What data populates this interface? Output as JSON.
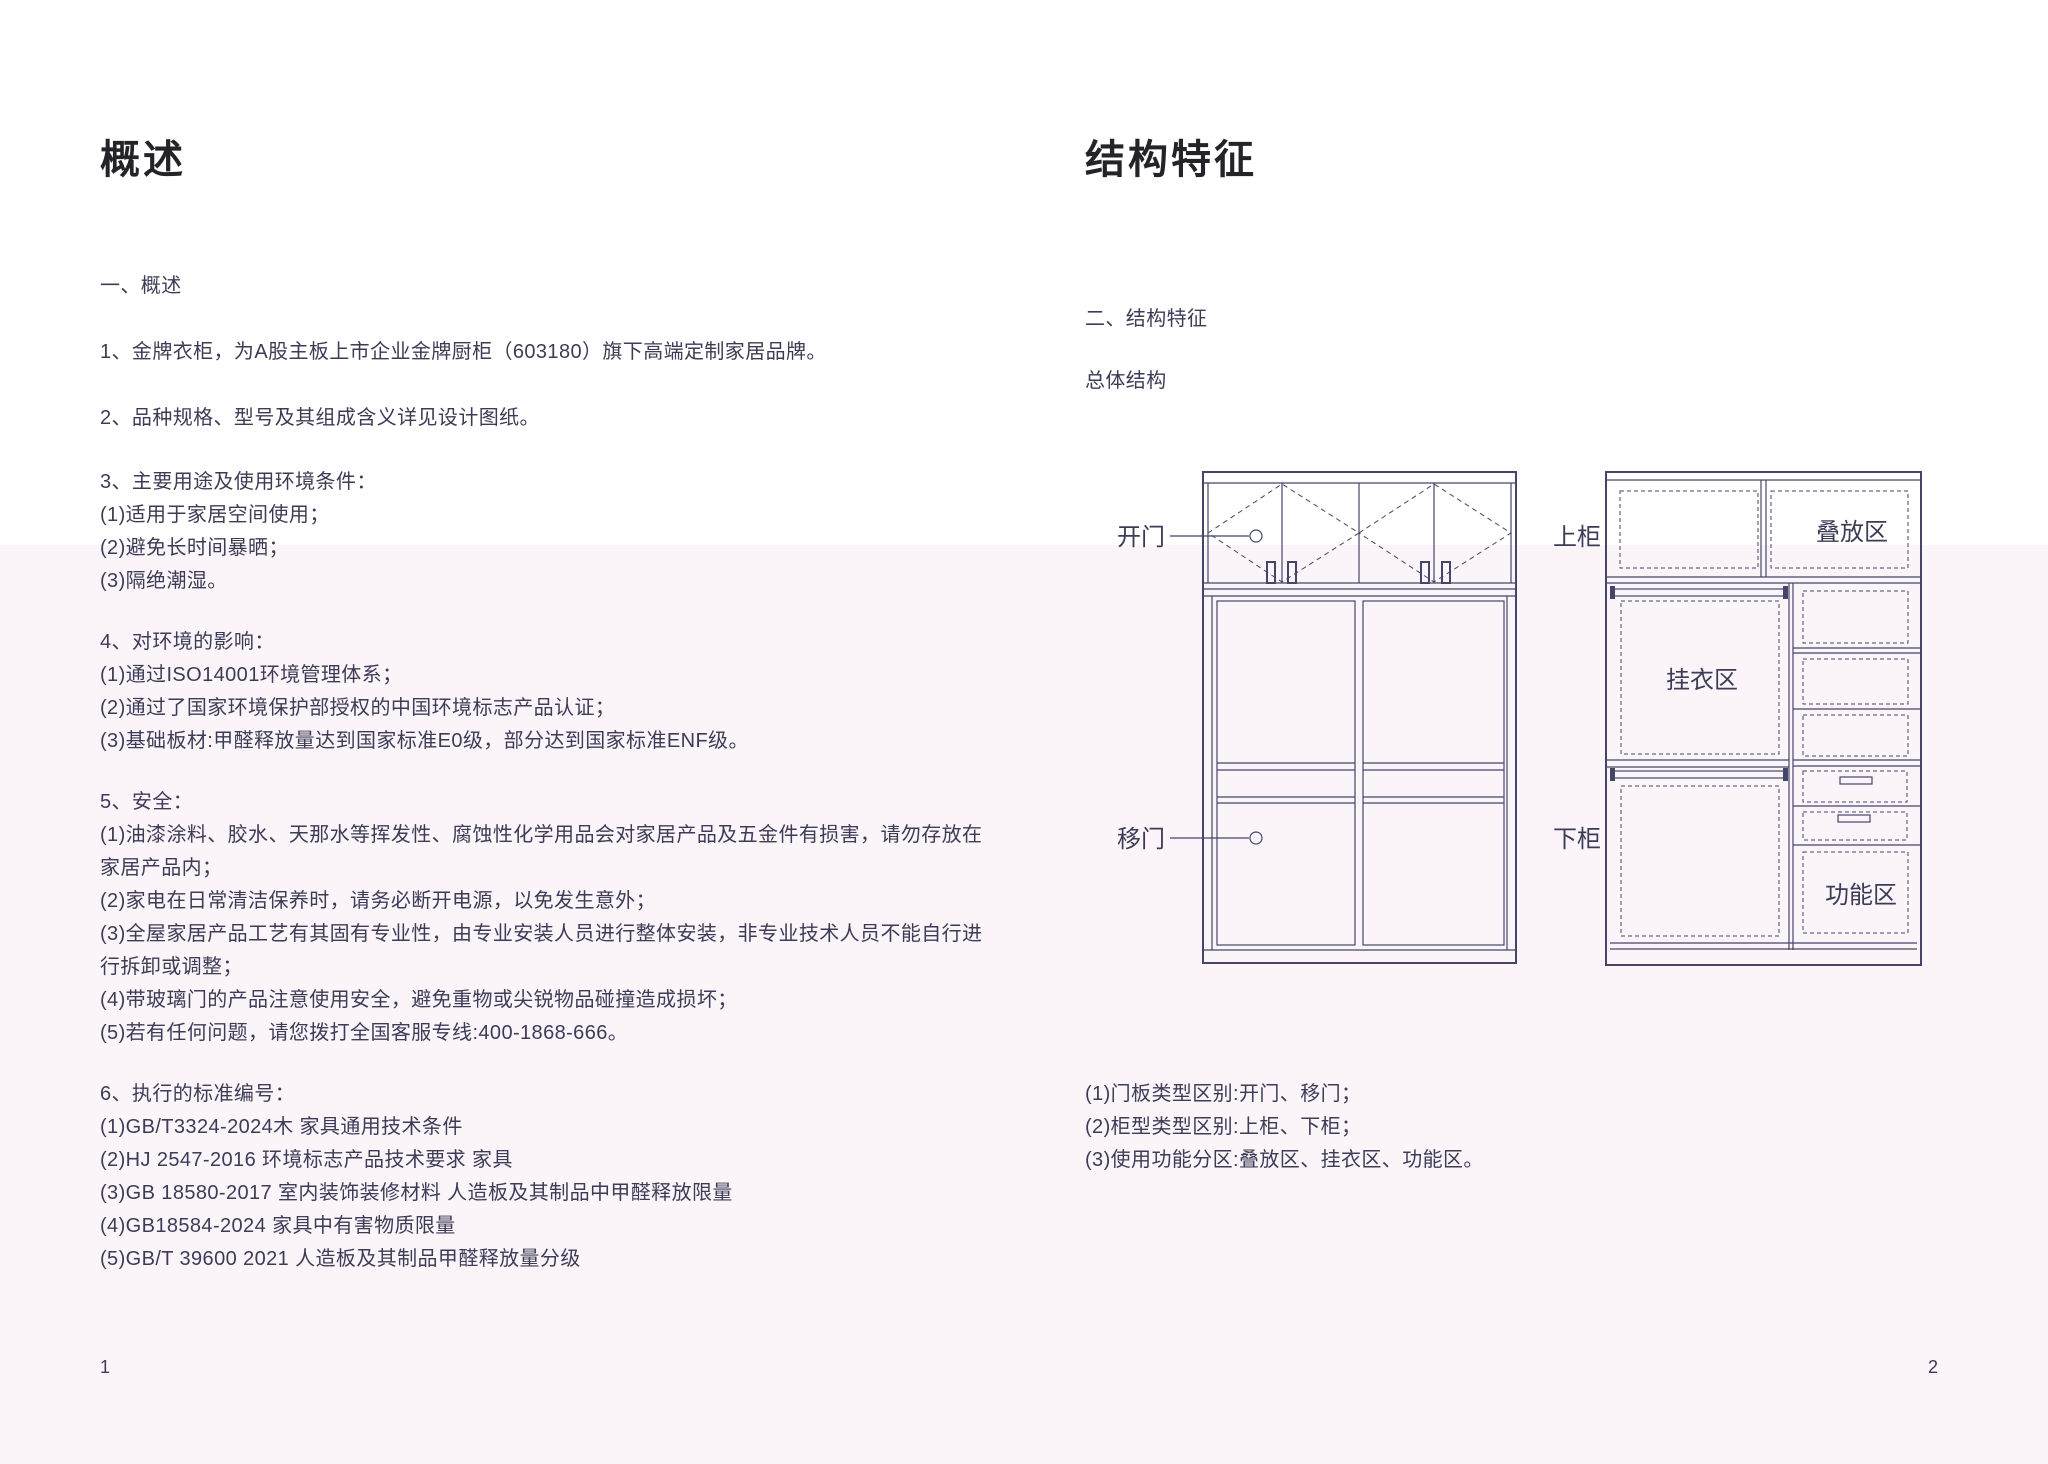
{
  "left_page": {
    "title": "概述",
    "section_heading": "一、概述",
    "intro_items": [
      "1、金牌衣柜，为A股主板上市企业金牌厨柜（603180）旗下高端定制家居品牌。",
      "2、品种规格、型号及其组成含义详见设计图纸。"
    ],
    "usage_block": [
      "3、主要用途及使用环境条件：",
      "(1)适用于家居空间使用；",
      "(2)避免长时间暴晒；",
      "(3)隔绝潮湿。"
    ],
    "environment_block": [
      "4、对环境的影响：",
      "(1)通过ISO14001环境管理体系；",
      "(2)通过了国家环境保护部授权的中国环境标志产品认证；",
      "(3)基础板材:甲醛释放量达到国家标准E0级，部分达到国家标准ENF级。"
    ],
    "safety_block": [
      "5、安全：",
      "(1)油漆涂料、胶水、天那水等挥发性、腐蚀性化学用品会对家居产品及五金件有损害，请勿存放在",
      "家居产品内；",
      "(2)家电在日常清洁保养时，请务必断开电源，以免发生意外；",
      "(3)全屋家居产品工艺有其固有专业性，由专业安装人员进行整体安装，非专业技术人员不能自行进",
      "行拆卸或调整；",
      "(4)带玻璃门的产品注意使用安全，避免重物或尖锐物品碰撞造成损坏；",
      "(5)若有任何问题，请您拨打全国客服专线:400-1868-666。"
    ],
    "standards_block": [
      "6、执行的标准编号：",
      "(1)GB/T3324-2024木 家具通用技术条件",
      "(2)HJ 2547-2016 环境标志产品技术要求 家具",
      "(3)GB 18580-2017 室内装饰装修材料 人造板及其制品中甲醛释放限量",
      "(4)GB18584-2024 家具中有害物质限量",
      "(5)GB/T 39600 2021 人造板及其制品甲醛释放量分级"
    ],
    "page_number": "1"
  },
  "right_page": {
    "title": "结构特征",
    "section_heading": "二、结构特征",
    "subsection_heading": "总体结构",
    "diagram_labels": {
      "swing_door": "开门",
      "sliding_door": "移门",
      "upper_cabinet": "上柜",
      "lower_cabinet": "下柜",
      "stacking_zone": "叠放区",
      "hanging_zone": "挂衣区",
      "function_zone": "功能区"
    },
    "notes": [
      "(1)门板类型区别:开门、移门；",
      "(2)柜型类型区别:上柜、下柜；",
      "(3)使用功能分区:叠放区、挂衣区、功能区。"
    ],
    "page_number": "2"
  },
  "colors": {
    "diagram_line": "#45456a",
    "body_text": "#3c3c56",
    "title_text": "#232328",
    "page_bg_top": "#ffffff",
    "page_bg_bottom": "#fbf5fa"
  }
}
